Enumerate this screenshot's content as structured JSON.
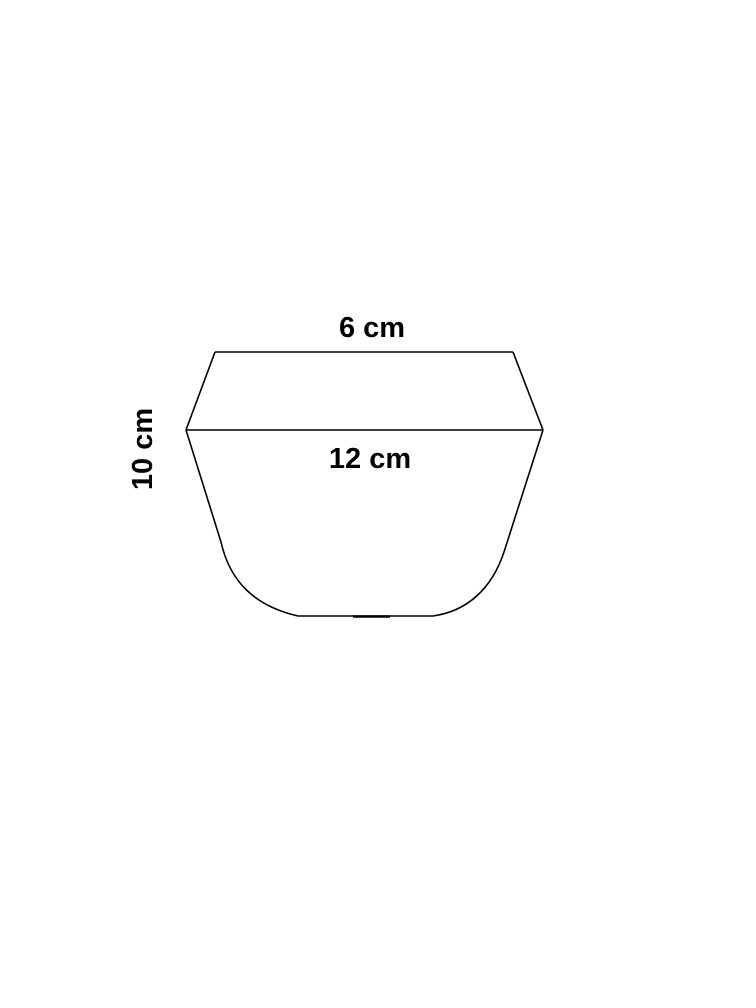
{
  "page": {
    "background_color": "#ffffff"
  },
  "diagram": {
    "kind": "geometric-cross-section",
    "line_color": "#000000",
    "text_color": "#000000",
    "labels": {
      "top_width": "6 cm",
      "middle_width": "12 cm",
      "height": "10 cm"
    },
    "measurements": {
      "top_width_cm": 6,
      "middle_width_cm": 12,
      "height_cm": 10
    }
  }
}
